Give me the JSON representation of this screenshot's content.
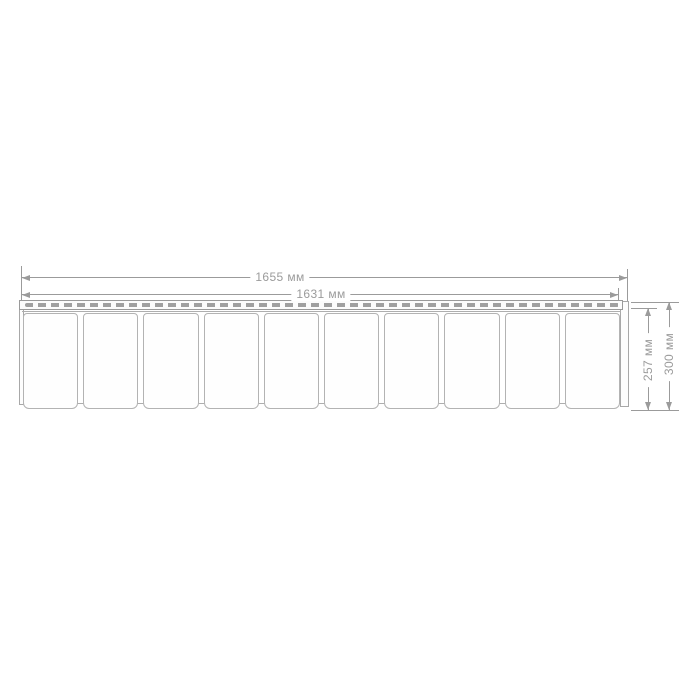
{
  "diagram": {
    "kind": "panel-dimension-drawing",
    "unit": "мм",
    "labels": {
      "width_overall": "1655 мм",
      "width_nail_strip": "1631 мм",
      "height_panel": "257 мм",
      "height_overall": "300 мм"
    },
    "values": {
      "width_overall_mm": 1655,
      "width_nail_strip_mm": 1631,
      "height_panel_mm": 257,
      "height_overall_mm": 300
    }
  },
  "panel": {
    "tile_count": 10,
    "has_nail_slot_strip": true
  },
  "colors": {
    "background": "#ffffff",
    "dimension_line": "#9b9b9b",
    "panel_outline": "#b3b3b3",
    "nail_slot": "#a0a0a0"
  }
}
